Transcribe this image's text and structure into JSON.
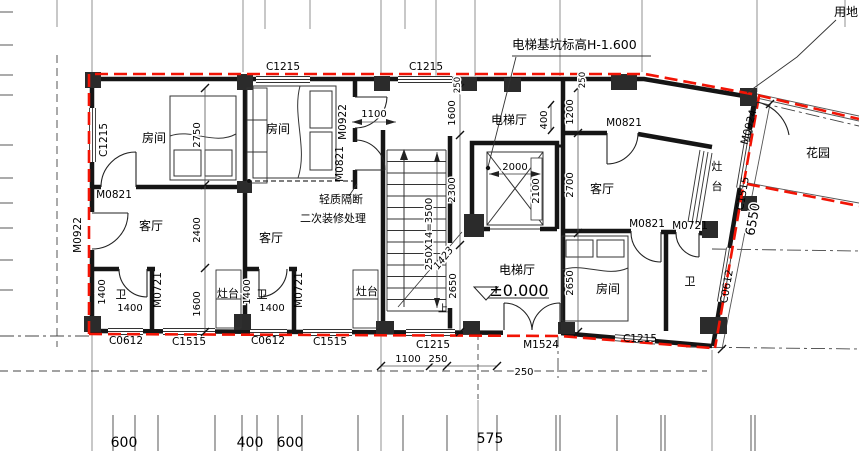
{
  "colors": {
    "boundary_red": "#f21405",
    "wall_black": "#151515"
  },
  "rooms": {
    "bedroom": "房间",
    "living_room": "客厅",
    "bathroom": "卫",
    "stove": "灶台",
    "stove_char_1": "灶",
    "stove_char_2": "台",
    "elevator_hall": "电梯厅",
    "garden": "花园"
  },
  "windows": {
    "c1215": "C1215",
    "c1515": "C1515",
    "c0612": "C0612"
  },
  "doors": {
    "m0922": "M0922",
    "m0821": "M0821",
    "m0721": "M0721",
    "m0924": "M0924",
    "m1524": "M1524"
  },
  "annotations": {
    "pit_level_note": "电梯基坑标高H-1.600",
    "site_boundary": "用地",
    "partition_note_line1": "轻质隔断",
    "partition_note_line2": "二次装修处理",
    "floor_level": "±0.000",
    "stair_up": "上"
  },
  "dims": {
    "d2750": "2750",
    "d2400": "2400",
    "d1600": "1600",
    "d1400": "1400",
    "d1100": "1100",
    "d2300": "2300",
    "stair_run": "250X14=3500",
    "d1423": "1423",
    "d2650": "2650",
    "d2000": "2000",
    "d2100": "2100",
    "d400": "400",
    "d1200": "1200",
    "d2700": "2700",
    "d6550": "6550",
    "d250": "250",
    "d600": "600",
    "d575": "575"
  }
}
